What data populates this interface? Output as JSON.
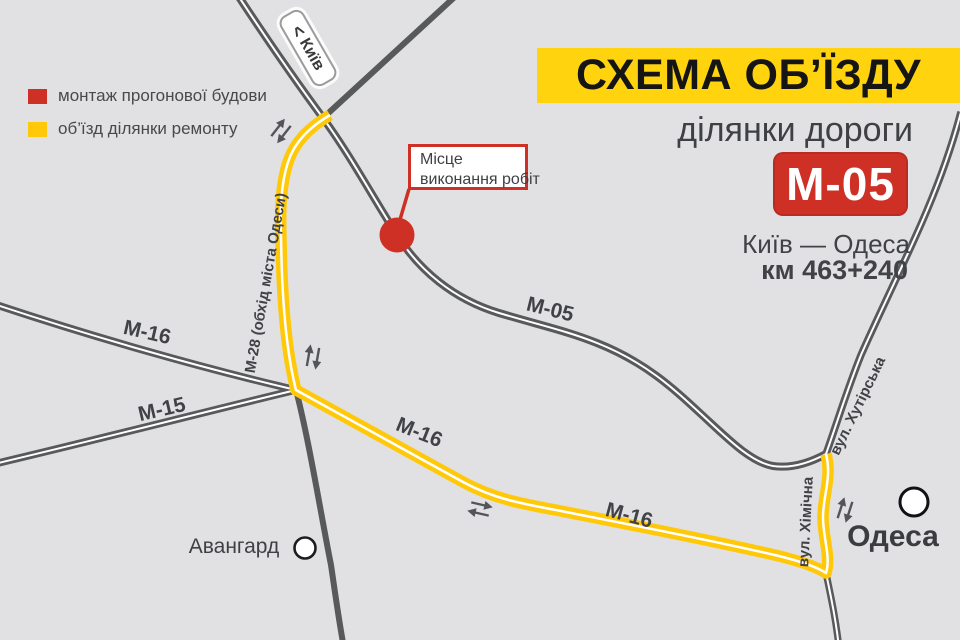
{
  "header": {
    "title": "СХЕМА ОБ’ЇЗДУ",
    "subtitle": "ділянки дороги",
    "badge": "М-05",
    "route": "Київ — Одеса",
    "km": "км 463+240"
  },
  "legend": {
    "items": [
      {
        "label": "монтаж прогонової будови",
        "color": "#ce3026"
      },
      {
        "label": "об’їзд ділянки ремонту",
        "color": "#ffc90a"
      }
    ]
  },
  "callout": {
    "line1": "Місце",
    "line2": "виконання робіт"
  },
  "direction_sign": {
    "arrow": "<",
    "label": "Київ"
  },
  "map_labels": {
    "m05": "М-05",
    "m16_nw": "М-16",
    "m15": "М-15",
    "m16_detour_1": "М-16",
    "m16_detour_2": "М-16",
    "m28": "М-28 (обхід міста Одеси)",
    "khutirska": "вул. Хутірська",
    "khimichna": "вул. Хімічна",
    "avangard": "Авангард",
    "odesa": "Одеса"
  },
  "colors": {
    "background": "#e1e1e3",
    "road_gray": "#58595b",
    "detour_yellow": "#ffc90a",
    "banner_yellow": "#ffd30d",
    "accent_red": "#ce3026",
    "text_dark": "#414246"
  }
}
